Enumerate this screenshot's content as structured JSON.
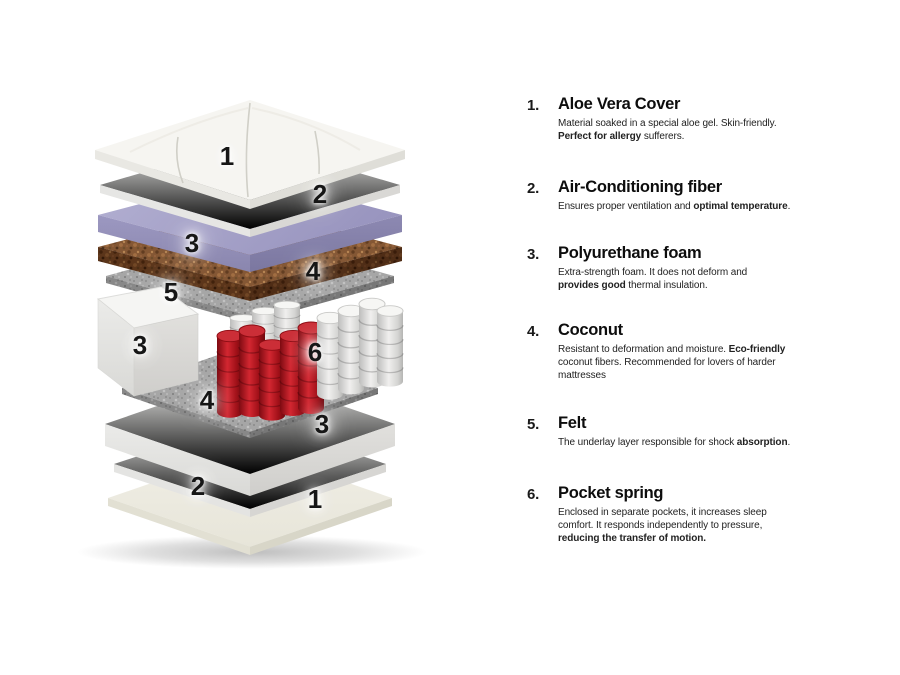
{
  "diagram": {
    "labels": [
      {
        "text": "1"
      },
      {
        "text": "2"
      },
      {
        "text": "3"
      },
      {
        "text": "4"
      },
      {
        "text": "5"
      },
      {
        "text": "3"
      },
      {
        "text": "6"
      },
      {
        "text": "4"
      },
      {
        "text": "3"
      },
      {
        "text": "2"
      },
      {
        "text": "1"
      }
    ],
    "materials": {
      "quilt_white": "#f3f2ee",
      "fiber_white": "#eeeeec",
      "polyurethane_purple": "#a7a4c8",
      "coconut_brown": "#7a4a26",
      "felt_gray": "#a3a3a3",
      "foam_white": "#f2f2f0",
      "cover_ivory": "#edebe0",
      "spring_red": "#c01420",
      "spring_white": "#efefed"
    }
  },
  "legend": {
    "items": [
      {
        "number": "1.",
        "title": "Aloe Vera Cover",
        "desc": [
          {
            "t": "Material soaked in a special aloe gel. Skin-friendly.\n"
          },
          {
            "t": "Perfect for allergy",
            "b": true
          },
          {
            "t": " sufferers."
          }
        ]
      },
      {
        "number": "2.",
        "title": "Air-Conditioning fiber",
        "desc": [
          {
            "t": "Ensures proper ventilation and "
          },
          {
            "t": "optimal temperature",
            "b": true
          },
          {
            "t": "."
          }
        ]
      },
      {
        "number": "3.",
        "title": "Polyurethane foam",
        "desc": [
          {
            "t": "Extra-strength foam. It does not deform and\n"
          },
          {
            "t": "provides good",
            "b": true
          },
          {
            "t": " thermal insulation."
          }
        ]
      },
      {
        "number": "4.",
        "title": "Coconut",
        "desc": [
          {
            "t": "Resistant to deformation and moisture. "
          },
          {
            "t": "Eco-friendly",
            "b": true
          },
          {
            "t": "\ncoconut fibers. Recommended for lovers of harder\nmattresses"
          }
        ]
      },
      {
        "number": "5.",
        "title": "Felt",
        "desc": [
          {
            "t": "The underlay layer responsible for shock "
          },
          {
            "t": "absorption",
            "b": true
          },
          {
            "t": "."
          }
        ]
      },
      {
        "number": "6.",
        "title": "Pocket spring",
        "desc": [
          {
            "t": "Enclosed in separate pockets, it increases sleep\ncomfort. It responds independently to pressure,\n"
          },
          {
            "t": "reducing the transfer of motion.",
            "b": true
          }
        ]
      }
    ]
  }
}
